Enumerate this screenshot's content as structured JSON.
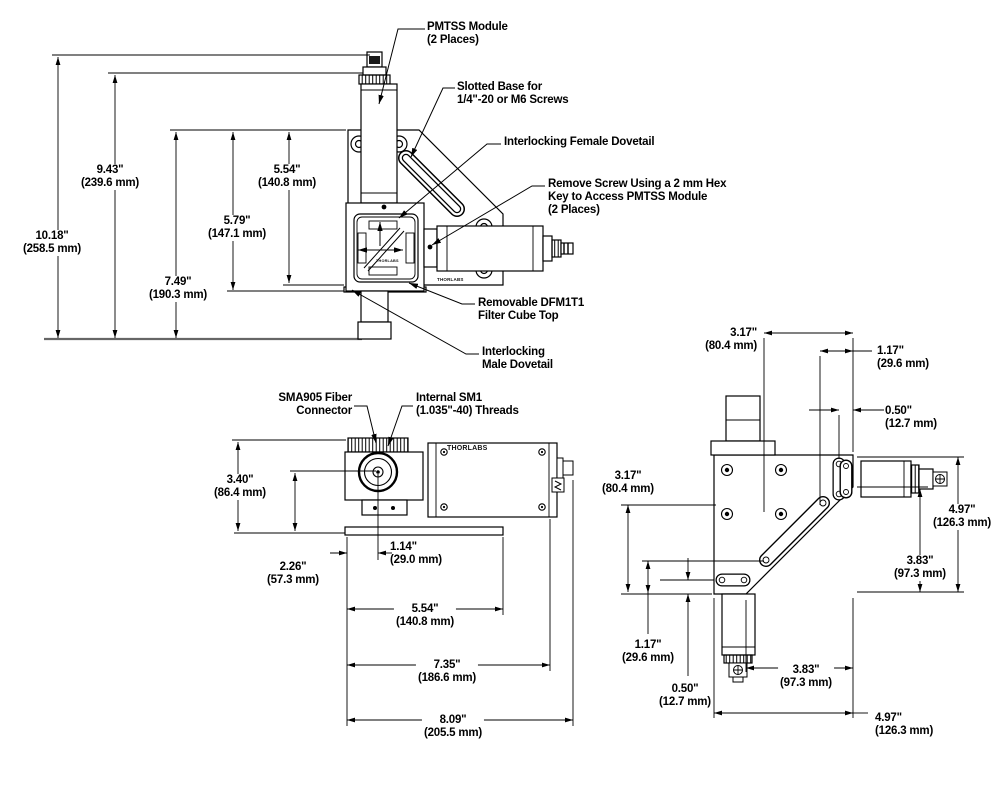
{
  "brand": "THORLABS",
  "views": {
    "front": {
      "dims": [
        {
          "id": "10-18",
          "value": "10.18\"",
          "metric": "(258.5 mm)"
        },
        {
          "id": "9-43",
          "value": "9.43\"",
          "metric": "(239.6 mm)"
        },
        {
          "id": "7-49",
          "value": "7.49\"",
          "metric": "(190.3 mm)"
        },
        {
          "id": "5-79",
          "value": "5.79\"",
          "metric": "(147.1 mm)"
        },
        {
          "id": "5-54",
          "value": "5.54\"",
          "metric": "(140.8 mm)"
        }
      ],
      "callouts": [
        {
          "id": "pmtss",
          "lines": [
            "PMTSS Module",
            "(2 Places)"
          ]
        },
        {
          "id": "slotted-base",
          "lines": [
            "Slotted Base for",
            "1/4\"-20 or M6 Screws"
          ]
        },
        {
          "id": "female-dovetail",
          "lines": [
            "Interlocking Female Dovetail"
          ]
        },
        {
          "id": "remove-screw",
          "lines": [
            "Remove Screw Using a 2 mm Hex",
            "Key to Access PMTSS Module",
            "(2 Places)"
          ]
        },
        {
          "id": "filter-cube",
          "lines": [
            "Removable DFM1T1",
            "Filter Cube Top"
          ]
        },
        {
          "id": "male-dovetail",
          "lines": [
            "Interlocking",
            "Male Dovetail"
          ]
        }
      ]
    },
    "side": {
      "callouts": [
        {
          "id": "sma905",
          "lines": [
            "SMA905 Fiber",
            "Connector"
          ]
        },
        {
          "id": "sm1",
          "lines": [
            "Internal SM1",
            "(1.035\"-40) Threads"
          ]
        }
      ],
      "dims": [
        {
          "id": "3-40",
          "value": "3.40\"",
          "metric": "(86.4 mm)"
        },
        {
          "id": "2-26",
          "value": "2.26\"",
          "metric": "(57.3 mm)"
        },
        {
          "id": "1-14",
          "value": "1.14\"",
          "metric": "(29.0 mm)"
        },
        {
          "id": "5-54",
          "value": "5.54\"",
          "metric": "(140.8 mm)"
        },
        {
          "id": "7-35",
          "value": "7.35\"",
          "metric": "(186.6 mm)"
        },
        {
          "id": "8-09",
          "value": "8.09\"",
          "metric": "(205.5 mm)"
        }
      ]
    },
    "top": {
      "dims": [
        {
          "id": "3-17-top",
          "value": "3.17\"",
          "metric": "(80.4 mm)"
        },
        {
          "id": "1-17-top",
          "value": "1.17\"",
          "metric": "(29.6 mm)"
        },
        {
          "id": "0-50-top",
          "value": "0.50\"",
          "metric": "(12.7 mm)"
        },
        {
          "id": "3-17-left",
          "value": "3.17\"",
          "metric": "(80.4 mm)"
        },
        {
          "id": "4-97-right",
          "value": "4.97\"",
          "metric": "(126.3 mm)"
        },
        {
          "id": "3-83-right",
          "value": "3.83\"",
          "metric": "(97.3 mm)"
        },
        {
          "id": "1-17-bottom",
          "value": "1.17\"",
          "metric": "(29.6 mm)"
        },
        {
          "id": "0-50-bottom",
          "value": "0.50\"",
          "metric": "(12.7 mm)"
        },
        {
          "id": "3-83-bottom",
          "value": "3.83\"",
          "metric": "(97.3 mm)"
        },
        {
          "id": "4-97-bottom",
          "value": "4.97\"",
          "metric": "(126.3 mm)"
        }
      ]
    }
  }
}
